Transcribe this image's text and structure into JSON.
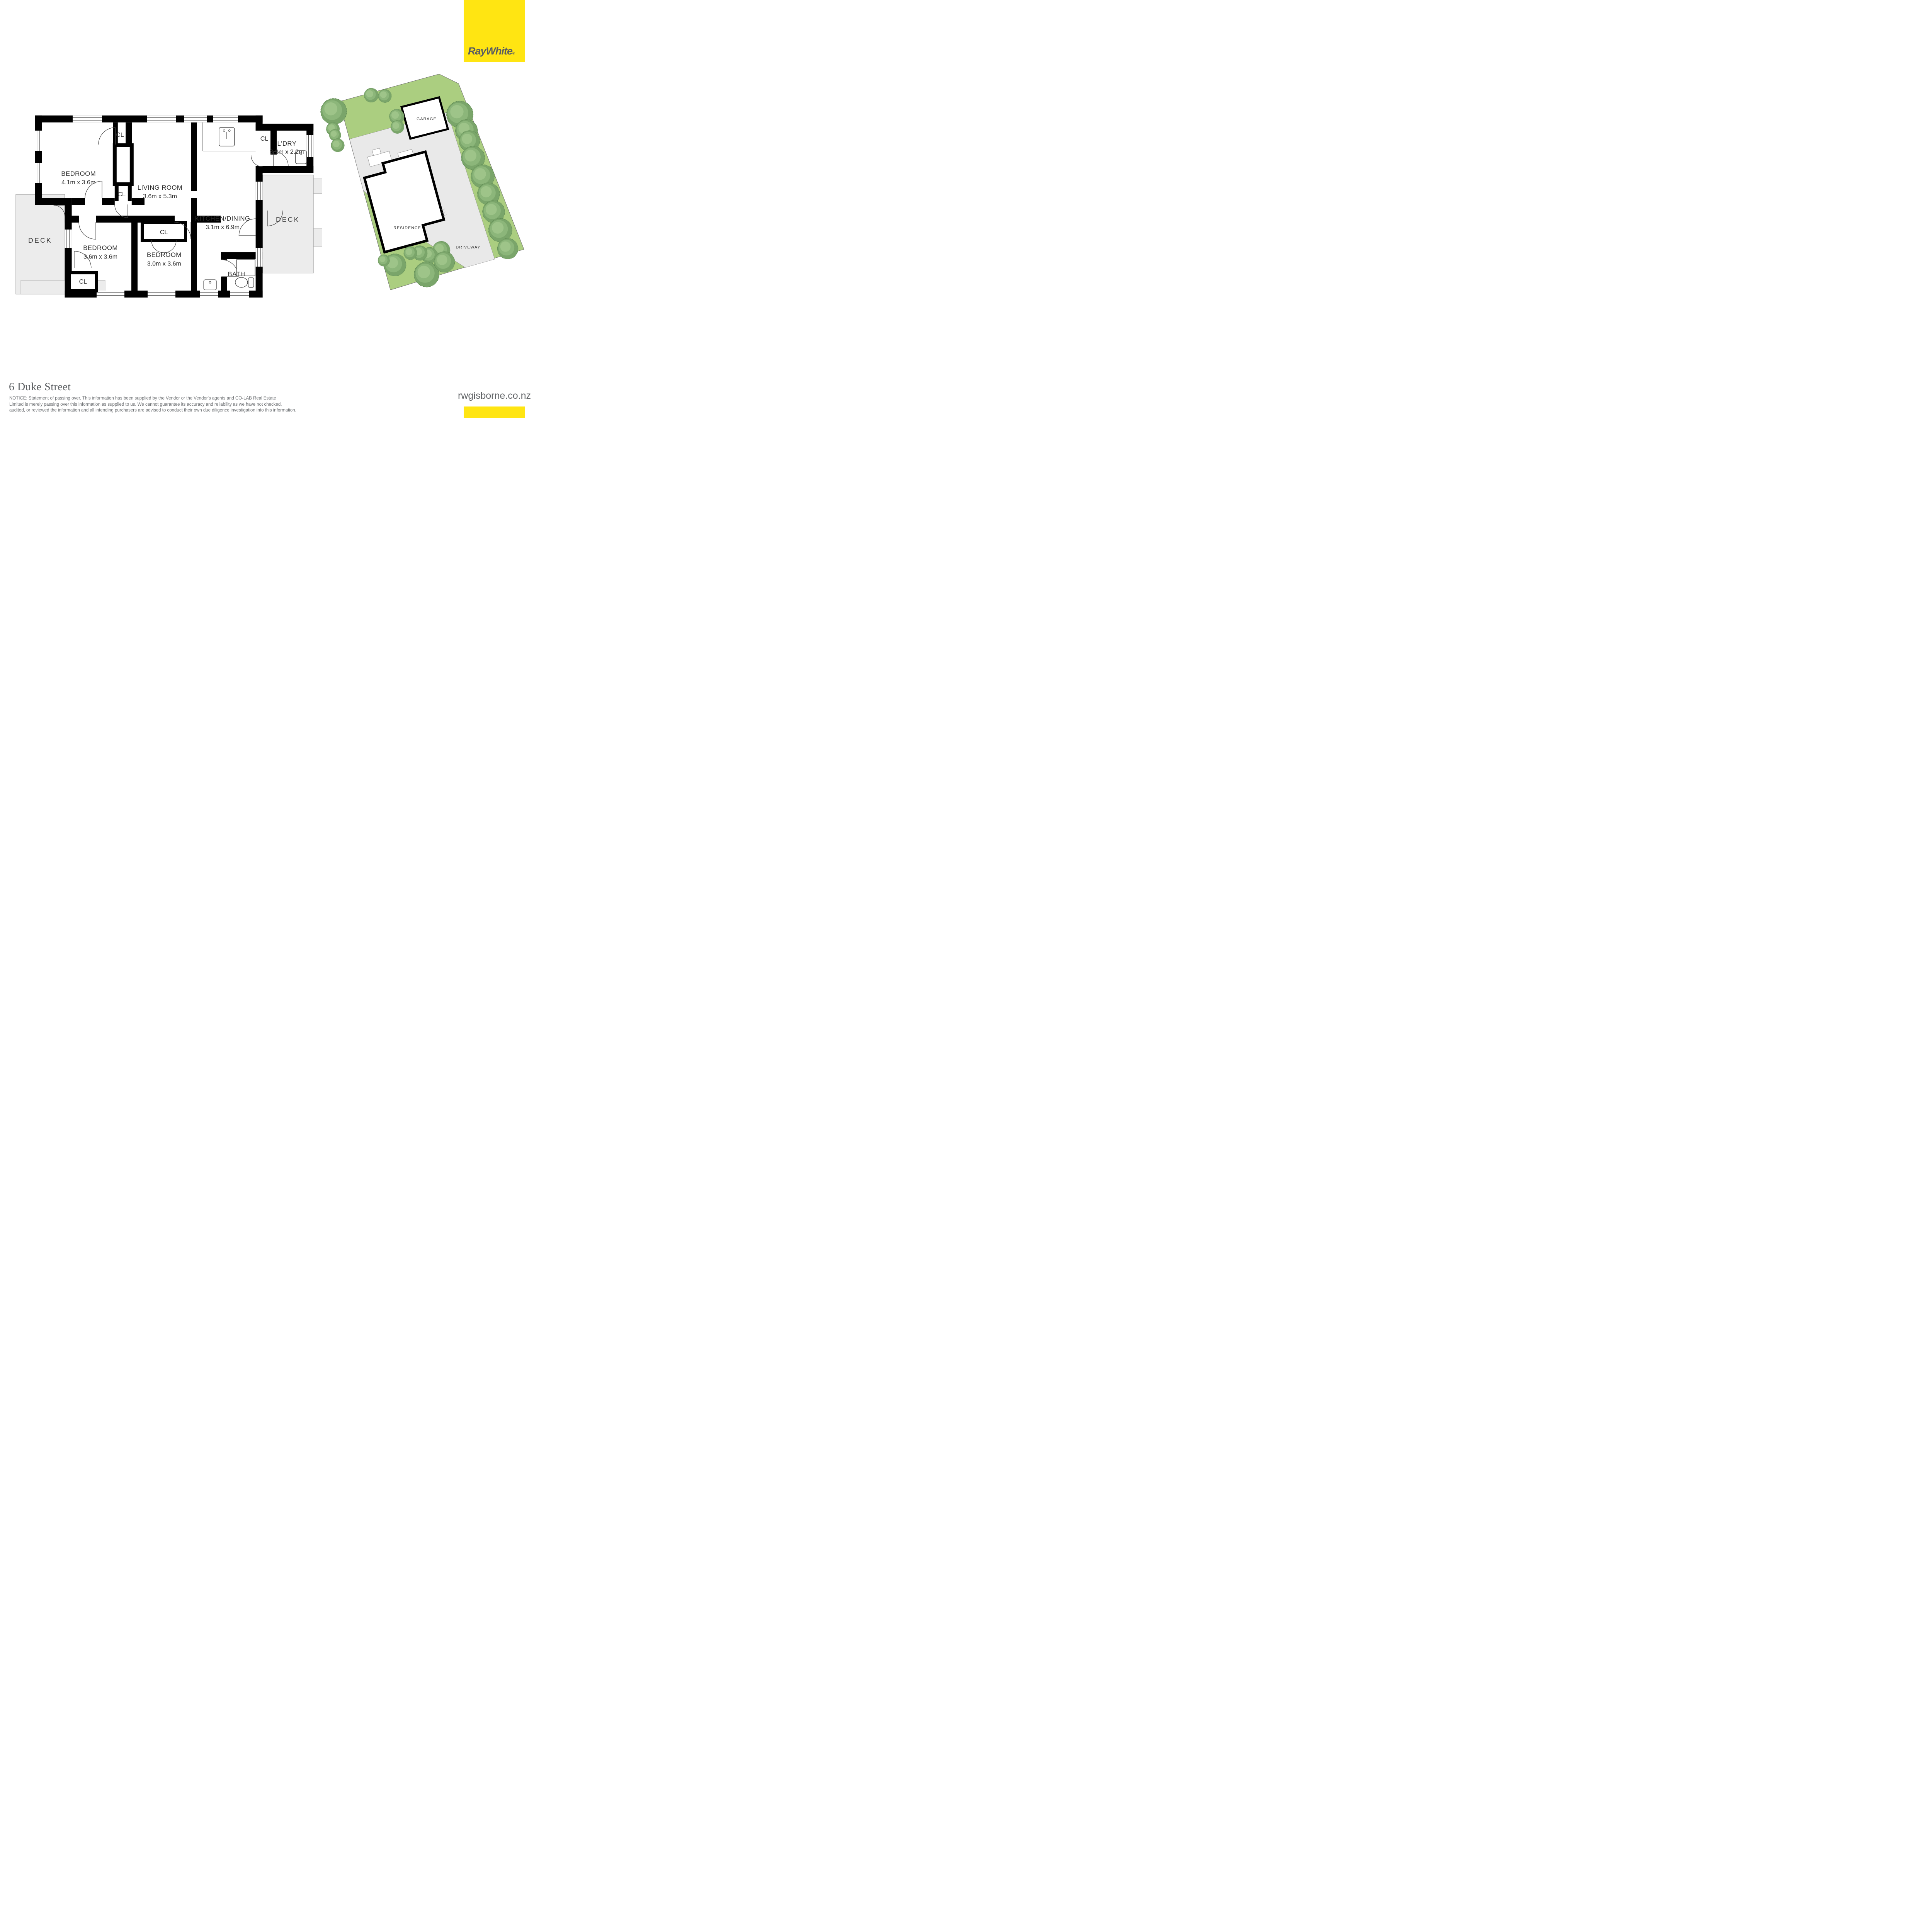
{
  "brand": {
    "logo_text": "RayWhite",
    "registered_mark": "®",
    "yellow": "#ffe512",
    "logo_text_color": "#595d62"
  },
  "floor_plan": {
    "rooms": [
      {
        "name": "BEDROOM",
        "dims": "4.1m x 3.6m"
      },
      {
        "name": "LIVING ROOM",
        "dims": "3.6m x 5.3m"
      },
      {
        "name": "KITCHEN/DINING",
        "dims": "3.1m x 6.9m"
      },
      {
        "name": "L'DRY",
        "dims": "3.3m x 2.2m"
      },
      {
        "name": "BEDROOM",
        "dims": "3.6m x 3.6m"
      },
      {
        "name": "BEDROOM",
        "dims": "3.0m x 3.6m"
      },
      {
        "name": "BATH"
      }
    ],
    "closet_label": "CL",
    "deck_label": "DECK"
  },
  "site_plan": {
    "garage_label": "GARAGE",
    "residence_label": "RESIDENCE",
    "driveway_label": "DRIVEWAY",
    "lawn_color": "#abce80",
    "tree_color": "#7aa56a",
    "paving_color": "#e9e9e9"
  },
  "footer": {
    "address": "6 Duke Street",
    "notice_lines": [
      "NOTICE: Statement of passing over. This information has been supplied by the Vendor or the Vendor's agents and CO-LAB Real Estate",
      "Limited is merely passing over this information as supplied to us. We cannot guarantee its accuracy and reliability as we have not checked,",
      "audited, or reviewed the information and all intending purchasers are advised to conduct their own due diligence investigation into this information."
    ],
    "website": "rwgisborne.co.nz"
  }
}
